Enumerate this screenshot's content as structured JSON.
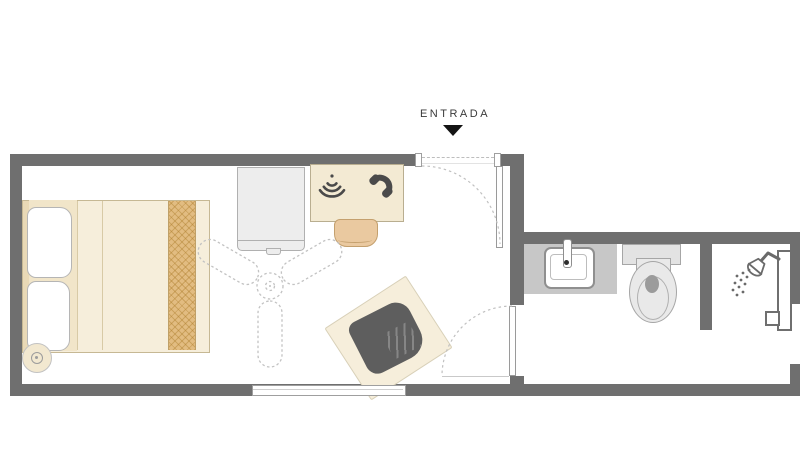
{
  "plan": {
    "entrance": {
      "label": "ENTRADA",
      "arrow_icon": "down-triangle-icon"
    },
    "colors": {
      "wall": "#6f6f6f",
      "floor": "#ffffff",
      "bed_beige": "#f6eedb",
      "bed_runner_tan": "#e2bc81",
      "desk_beige": "#f3ead3",
      "stool_tan": "#eac9a0",
      "chair_dark": "#5e5e5e",
      "counter_gray": "#c7c7c7",
      "fixture_gray": "#e9e9e9",
      "icon_dark": "#4a4a4a"
    },
    "bedroom": {
      "name": "bedroom",
      "items": [
        {
          "name": "double-bed"
        },
        {
          "name": "pillow-top"
        },
        {
          "name": "pillow-bottom"
        },
        {
          "name": "bed-runner"
        },
        {
          "name": "bedside-dial"
        },
        {
          "name": "dresser"
        },
        {
          "name": "desk"
        },
        {
          "name": "wifi-icon"
        },
        {
          "name": "phone-icon"
        },
        {
          "name": "stool"
        },
        {
          "name": "ceiling-fan"
        },
        {
          "name": "armchair-on-rug"
        },
        {
          "name": "window"
        },
        {
          "name": "entrance-door"
        },
        {
          "name": "bathroom-door"
        }
      ]
    },
    "bathroom": {
      "name": "bathroom",
      "items": [
        {
          "name": "sink-counter"
        },
        {
          "name": "sink"
        },
        {
          "name": "faucet"
        },
        {
          "name": "toilet"
        },
        {
          "name": "shower-partition"
        },
        {
          "name": "shower-head-icon"
        },
        {
          "name": "shower-rail"
        }
      ]
    }
  }
}
